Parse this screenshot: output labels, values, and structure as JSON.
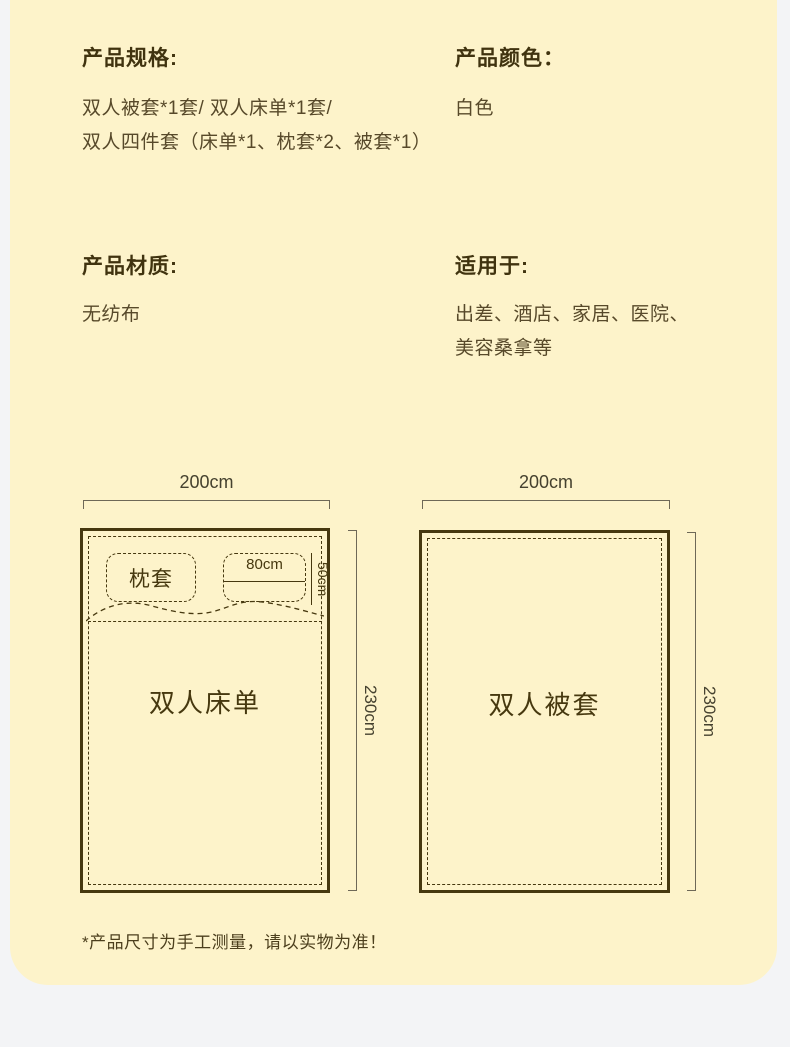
{
  "page": {
    "card_background": "#fdf3ca",
    "outer_background": "#f3f4f6",
    "text_color": "#46380f"
  },
  "sections": {
    "spec": {
      "title": "产品规格:",
      "lines": [
        "双人被套*1套/ 双人床单*1套/",
        "双人四件套（床单*1、枕套*2、被套*1）"
      ]
    },
    "color": {
      "title": "产品颜色：",
      "value": "白色"
    },
    "material": {
      "title": "产品材质:",
      "value": "无纺布"
    },
    "usage": {
      "title": "适用于:",
      "lines": [
        "出差、酒店、家居、医院、",
        "美容桑拿等"
      ]
    }
  },
  "diagrams": {
    "sheet": {
      "label": "双人床单",
      "width_label": "200cm",
      "height_label": "230cm",
      "pillow_label": "枕套",
      "pillow_width_label": "80cm",
      "pillow_height_label": "50cm"
    },
    "duvet": {
      "label": "双人被套",
      "width_label": "200cm",
      "height_label": "230cm"
    }
  },
  "footnote": "*产品尺寸为手工测量，请以实物为准！"
}
